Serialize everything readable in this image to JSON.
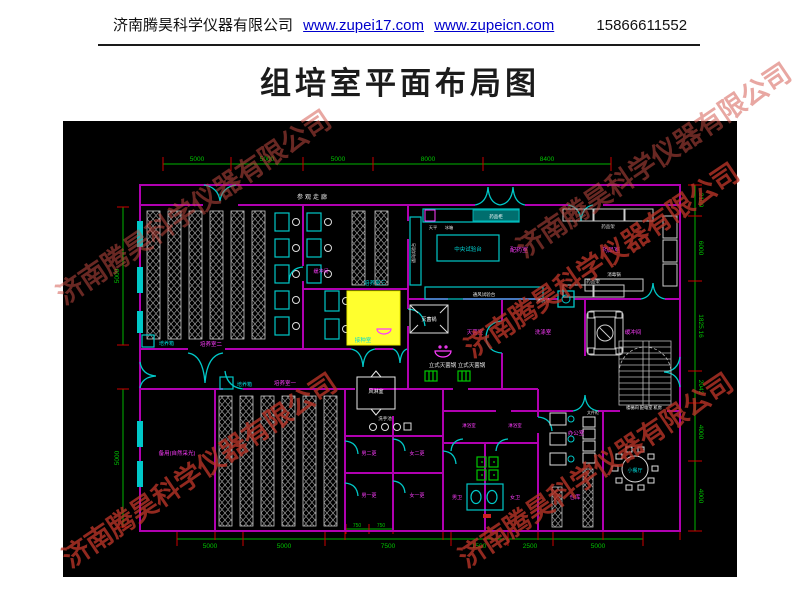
{
  "header": {
    "company": "济南腾昊科学仪器有限公司",
    "link1": "www.zupei17.com",
    "link2": "www.zupeicn.com",
    "phone": "15866611552"
  },
  "title": "组培室平面布局图",
  "watermark": {
    "text": "济南腾昊科学仪器有限公司"
  },
  "colors": {
    "canvas": "#000000",
    "wall": "#b000b0",
    "fixture_cyan": "#00c8c8",
    "dim_green": "#00b400",
    "tick_red": "#cc0000",
    "hatch_gray": "#9a9a9a",
    "highlight_yellow": "#ffff2e",
    "label_magenta": "#ff3cff",
    "watermark_red": "#bb3428",
    "link_blue": "#0000cc"
  },
  "plan": {
    "labels": {
      "corridor": "参观走廊",
      "room2": "培养室二",
      "room3": "培养室三",
      "room1": "培养室一",
      "buffer_mid": "缓冲间",
      "inoculation": "接种室",
      "incubator": "培养箱",
      "spare": "备用(自然采光)",
      "prep": "配药室",
      "medicine": "药品室",
      "sterilize": "灭菌室",
      "wash": "洗涤室",
      "buffer_right": "缓冲间",
      "airshower": "风淋室",
      "handsink": "洗手池",
      "chg_m2": "男二更",
      "chg_f2": "女二更",
      "chg_m1": "男一更",
      "chg_f1": "女一更",
      "shower": "淋浴室",
      "wc_m": "男卫",
      "wc_f": "女卫",
      "office": "办公室",
      "cabinet": "文件柜",
      "storage": "仓库",
      "dining": "小餐厅",
      "utility": "楼梯间 配电室 机房"
    },
    "equipment": {
      "central_bench": "中央试验台",
      "fume_bench": "通风试验台",
      "med_cabinet": "药品柜",
      "med_shelf": "药品架",
      "balance": "天平",
      "fridge": "冰箱",
      "sterilizer_pot": "灭菌锅",
      "autoclaves": "立式灭菌锅 立式灭菌锅",
      "wash_sink": "清洗池",
      "disinfect_pot": "消毒锅"
    },
    "dims": {
      "top": [
        "5000",
        "5000",
        "5000",
        "8000",
        "8400"
      ],
      "right": [
        "2100",
        "6000",
        "1825.16",
        "2042",
        "4000",
        "4000"
      ],
      "left": [
        "5000",
        "5000"
      ],
      "bottom": [
        "5000",
        "5000",
        "7500",
        "1500",
        "2500",
        "5000"
      ],
      "bottom_inner": [
        "750",
        "750"
      ]
    }
  }
}
